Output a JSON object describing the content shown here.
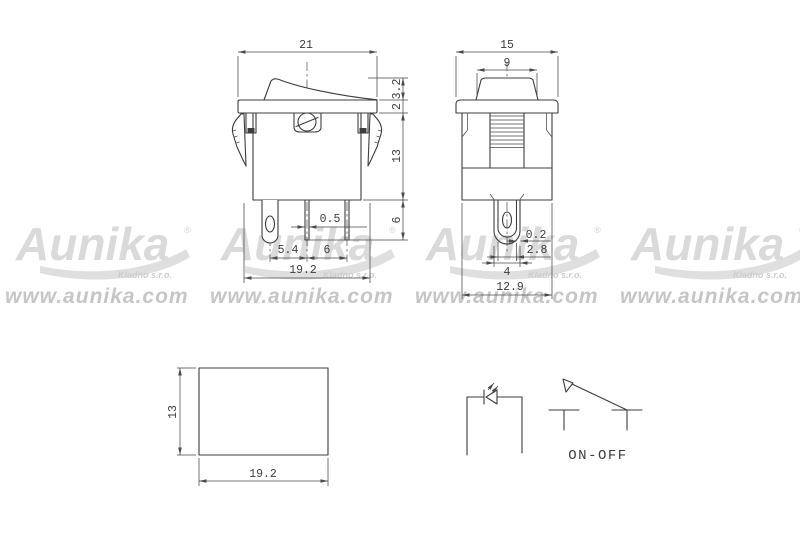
{
  "colors": {
    "background": "#ffffff",
    "line": "#3d3d3d",
    "watermark_logo": "#dadada",
    "watermark_url": "#c6c6c6"
  },
  "watermark": {
    "brand": "Aunika",
    "registered": "®",
    "subtitle": "Kladno s.r.o.",
    "url": "www.aunika.com"
  },
  "front_view": {
    "dims": {
      "overall_width": "21",
      "rocker_height": "3.2",
      "flange_thickness": "2",
      "body_height": "13",
      "terminal_length": "6",
      "terminal_thickness": "0.5",
      "pin_pitch_left": "5.4",
      "pin_pitch_right": "6",
      "body_length": "19.2"
    }
  },
  "side_view": {
    "dims": {
      "overall_width": "15",
      "rocker_width": "9",
      "terminal_sheet_thickness": "0.2",
      "terminal_width": "2.8",
      "terminal_slot_width": "4",
      "body_width": "12.9"
    }
  },
  "cutout_view": {
    "dims": {
      "height": "13",
      "width": "19.2"
    }
  },
  "symbols": {
    "switch_label": "ON-OFF"
  }
}
